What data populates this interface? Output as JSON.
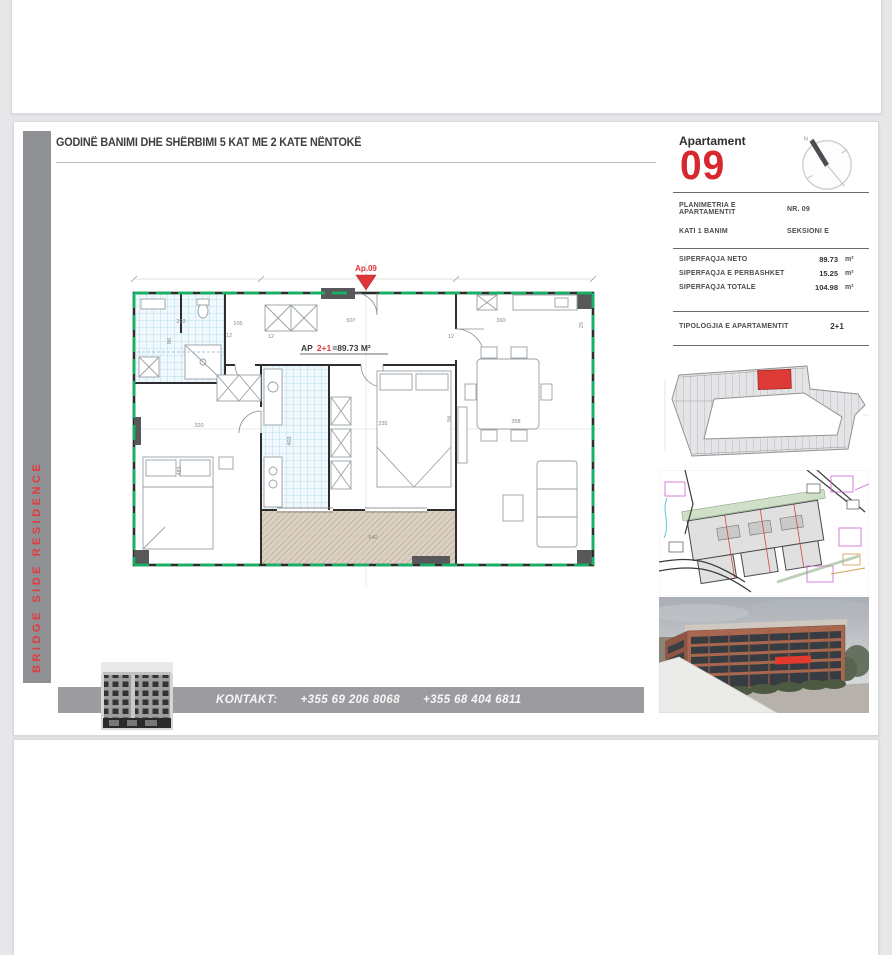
{
  "header": {
    "title": "GODINË BANIMI DHE SHËRBIMI 5 KAT ME 2 KATE NËNTOKË"
  },
  "brand": {
    "vertical_text": "BRIDGE SIDE RESIDENCE",
    "accent": "#e23b3d"
  },
  "apartment_panel": {
    "label": "Apartament",
    "number": "09",
    "compass_label": "N",
    "info_rows": [
      {
        "label": "PLANIMETRIA E APARTAMENTIT",
        "value": "NR. 09"
      },
      {
        "label": "KATI 1 BANIM",
        "value": "SEKSIONI E"
      }
    ],
    "area_rows": [
      {
        "label": "SIPERFAQJA NETO",
        "value": "89.73",
        "unit": "m²"
      },
      {
        "label": "SIPERFAQJA E PERBASHKET",
        "value": "15.25",
        "unit": "m²"
      },
      {
        "label": "SIPERFAQJA TOTALE",
        "value": "104.98",
        "unit": "m²"
      }
    ],
    "typology_row": {
      "label": "TIPOLOGJIA E APARTAMENTIT",
      "value": "2+1"
    }
  },
  "floor_plan": {
    "marker_label": "Ap.09",
    "unit_label": {
      "prefix": "AP",
      "type": "2+1",
      "suffix": "=89.73 M²"
    },
    "dimensions": [
      {
        "t": "203",
        "x": 56,
        "y": 66
      },
      {
        "t": "105",
        "x": 113,
        "y": 68
      },
      {
        "t": "507",
        "x": 226,
        "y": 65
      },
      {
        "t": "360",
        "x": 376,
        "y": 65
      },
      {
        "t": "86",
        "x": 46,
        "y": 84,
        "r": 90
      },
      {
        "t": "12",
        "x": 104,
        "y": 80
      },
      {
        "t": "12",
        "x": 146,
        "y": 81
      },
      {
        "t": "12",
        "x": 326,
        "y": 81
      },
      {
        "t": "320",
        "x": 74,
        "y": 170
      },
      {
        "t": "483",
        "x": 56,
        "y": 214,
        "r": 90
      },
      {
        "t": "403",
        "x": 166,
        "y": 184,
        "r": 90
      },
      {
        "t": "335",
        "x": 258,
        "y": 168
      },
      {
        "t": "94",
        "x": 326,
        "y": 162,
        "r": 90
      },
      {
        "t": "358",
        "x": 391,
        "y": 166
      },
      {
        "t": "540",
        "x": 248,
        "y": 282
      },
      {
        "t": "25",
        "x": 458,
        "y": 68,
        "r": 90
      }
    ]
  },
  "contact": {
    "label": "KONTAKT:",
    "phone1": "+355 69 206 8068",
    "phone2": "+355 68 404 6811"
  },
  "colors": {
    "accent_red": "#d6292e",
    "plan_green": "#15b264",
    "bar_gray": "#9c9ca0",
    "tile_blue": "#92c9de",
    "terrace_tan": "#dbd1c2"
  }
}
